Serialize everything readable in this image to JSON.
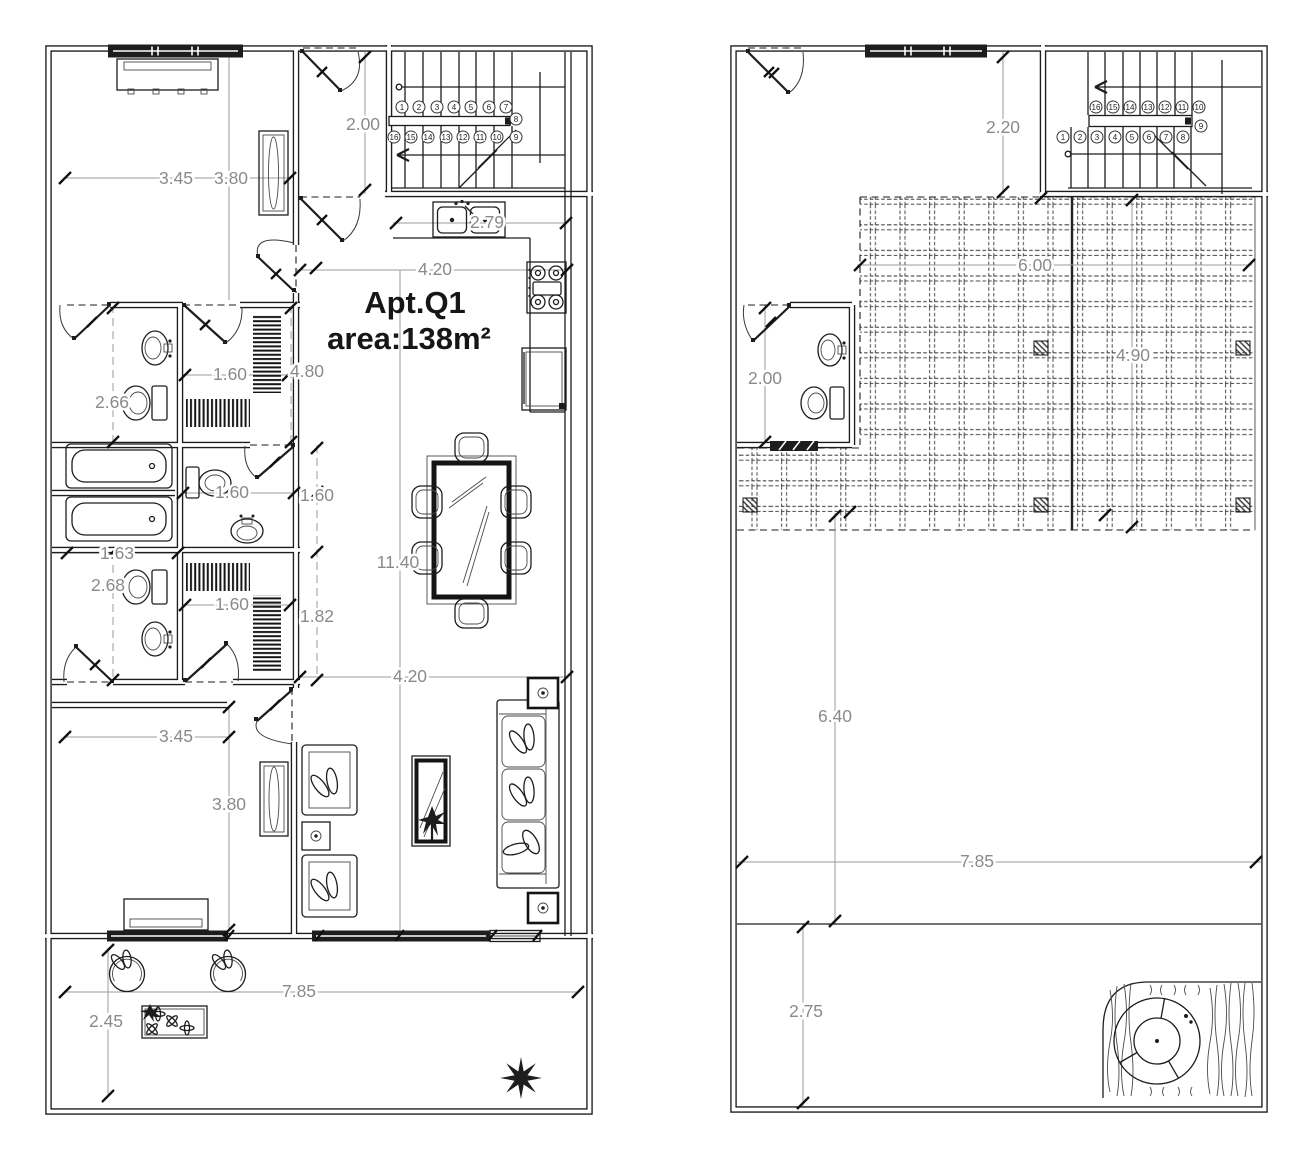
{
  "plan_left": {
    "apartment": {
      "name": "Apt.Q1",
      "area": "area:138m²"
    },
    "dims": {
      "hall_width": "2.00",
      "bed1_width": "3.45",
      "bed1_depth": "3.80",
      "kitchen_width": "4.20",
      "counter": "2.79",
      "closet1_width": "1.60",
      "bath_col_height": "4.80",
      "bath1_width": "2.66",
      "wc_width": "1.60",
      "wc_height": "1.60",
      "tub_width": "1.63",
      "bath2_width": "2.68",
      "closet2_width": "1.60",
      "closet2_height": "1.82",
      "apartment_length": "11.40",
      "living_width": "4.20",
      "bed2_width": "3.45",
      "bed2_depth": "3.80",
      "balcony_width": "7.85",
      "balcony_depth": "2.45"
    },
    "stairs": {
      "run_up": [
        "1",
        "2",
        "3",
        "4",
        "5",
        "6",
        "7"
      ],
      "landing_up": "8",
      "run_down": [
        "16",
        "15",
        "14",
        "13",
        "12",
        "11",
        "10"
      ],
      "landing_down": "9"
    }
  },
  "plan_right": {
    "dims": {
      "stair_hall_width": "2.20",
      "roof_width": "6.00",
      "bath_width": "2.00",
      "roof_depth": "4.90",
      "terrace_depth": "6.40",
      "terrace_width": "7.85",
      "patio_depth": "2.75"
    },
    "stairs": {
      "run_up": [
        "16",
        "15",
        "14",
        "13",
        "12",
        "11",
        "10"
      ],
      "landing_up": "9",
      "run_down": [
        "1",
        "2",
        "3",
        "4",
        "5",
        "6",
        "7",
        "8"
      ]
    }
  },
  "colors": {
    "line": "#1d1d1d",
    "dim_text": "#8a8a8a",
    "paper": "#ffffff"
  }
}
